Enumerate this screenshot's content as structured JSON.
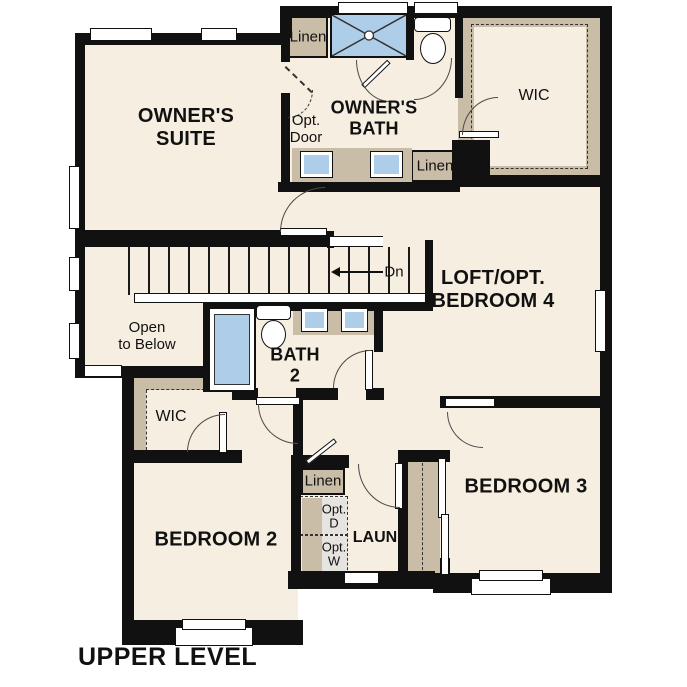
{
  "title": {
    "upper_level": "UPPER LEVEL"
  },
  "rooms": {
    "owners_suite": "OWNER'S\nSUITE",
    "owners_bath": "OWNER'S\nBATH",
    "wic_upper": "WIC",
    "loft": "LOFT/OPT.\nBEDROOM 4",
    "open_to_below": "Open\nto Below",
    "bath_2": "BATH\n2",
    "wic_lower": "WIC",
    "bedroom_2": "BEDROOM 2",
    "bedroom_3": "BEDROOM 3",
    "laundry": "LAUN"
  },
  "labels": {
    "linen_top": "Linen",
    "linen_mid": "Linen",
    "linen_hall": "Linen",
    "opt_door": "Opt.\nDoor",
    "opt_dryer": "Opt.\nD",
    "opt_washer": "Opt.\nW",
    "stairs_down": "Dn"
  },
  "colors": {
    "floor": "#f6eee0",
    "wall": "#111111",
    "cabinet": "#c9bda8",
    "fixture": "#aecde9"
  }
}
